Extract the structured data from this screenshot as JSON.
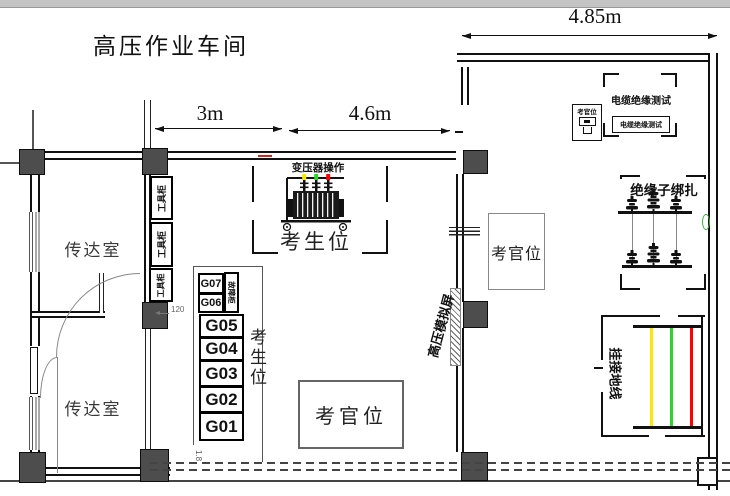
{
  "title": "高压作业车间",
  "dims": {
    "top_right": "4.85m",
    "left_span": "3m",
    "mid_span": "4.6m",
    "cabinet_offset": "120",
    "g_offset": "1.8"
  },
  "rooms": {
    "reception_top": "传达室",
    "reception_bottom": "传达室"
  },
  "labels": {
    "tool_cabinet": "工具柜",
    "fault_cabinet": "故障柜",
    "transformer_op": "变压器操作",
    "examinee_transformer": "考生位",
    "examinee_g_area": "考生位",
    "examiner_main": "考官位",
    "examiner_right": "考官位",
    "examiner_cable": "考官位",
    "cable_test": "电缆绝缘测试",
    "cable_test_box": "电缆绝缘测试",
    "insulator_binding": "绝缘子绑扎",
    "ground_wire": "挂接地线",
    "hv_sim_screen": "高压模拟屏"
  },
  "g_slots": [
    "G07",
    "G06",
    "G05",
    "G04",
    "G03",
    "G02",
    "G01"
  ],
  "colors": {
    "phase_yellow": "#ffe600",
    "phase_green": "#2fd32f",
    "phase_red": "#ff0000",
    "wall_mark_red": "#cc2a1e",
    "door_handle_green": "#44aa44"
  }
}
